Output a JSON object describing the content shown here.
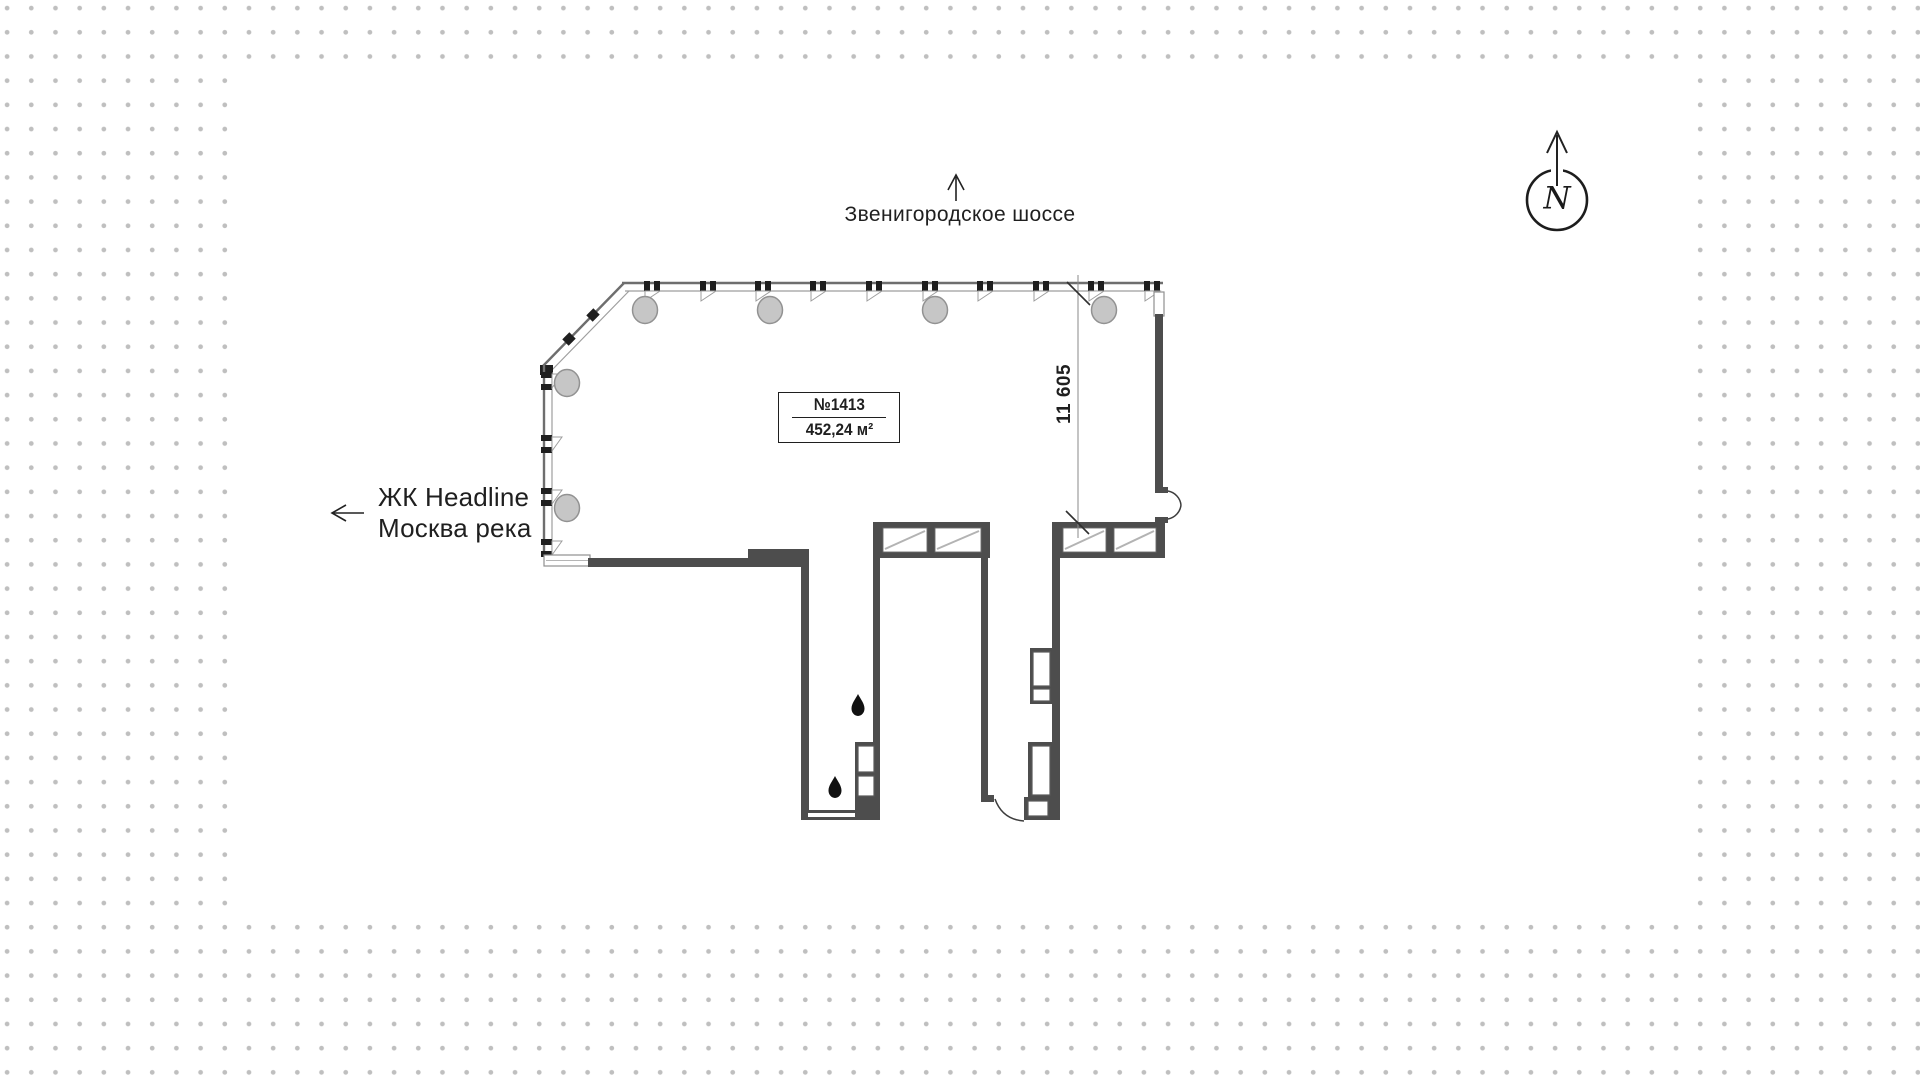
{
  "colors": {
    "wall_dark": "#4d4d4d",
    "line_light": "#9e9e9e",
    "line_mid": "#6e6e6e",
    "column_fill": "#c6c6c6",
    "column_stroke": "#929292",
    "ink": "#1f1f1f",
    "dot": "#bfbfbf",
    "panel": "#ffffff",
    "shade": "#b3b3b3"
  },
  "background": {
    "dot_grid_spacing_px": 24
  },
  "compass": {
    "label": "N"
  },
  "labels": {
    "top_road": "Звенигородское шоссе",
    "complex_line1": "ЖК Headline",
    "complex_line2": "Москва река"
  },
  "unit": {
    "number": "№1413",
    "area": "452,24 м²"
  },
  "dimensions": {
    "right_span": "11 605"
  },
  "icons": {
    "north_arrow": "↑",
    "west_arrow": "←",
    "north_compass": "N in circle",
    "water_drop": "teardrop"
  }
}
